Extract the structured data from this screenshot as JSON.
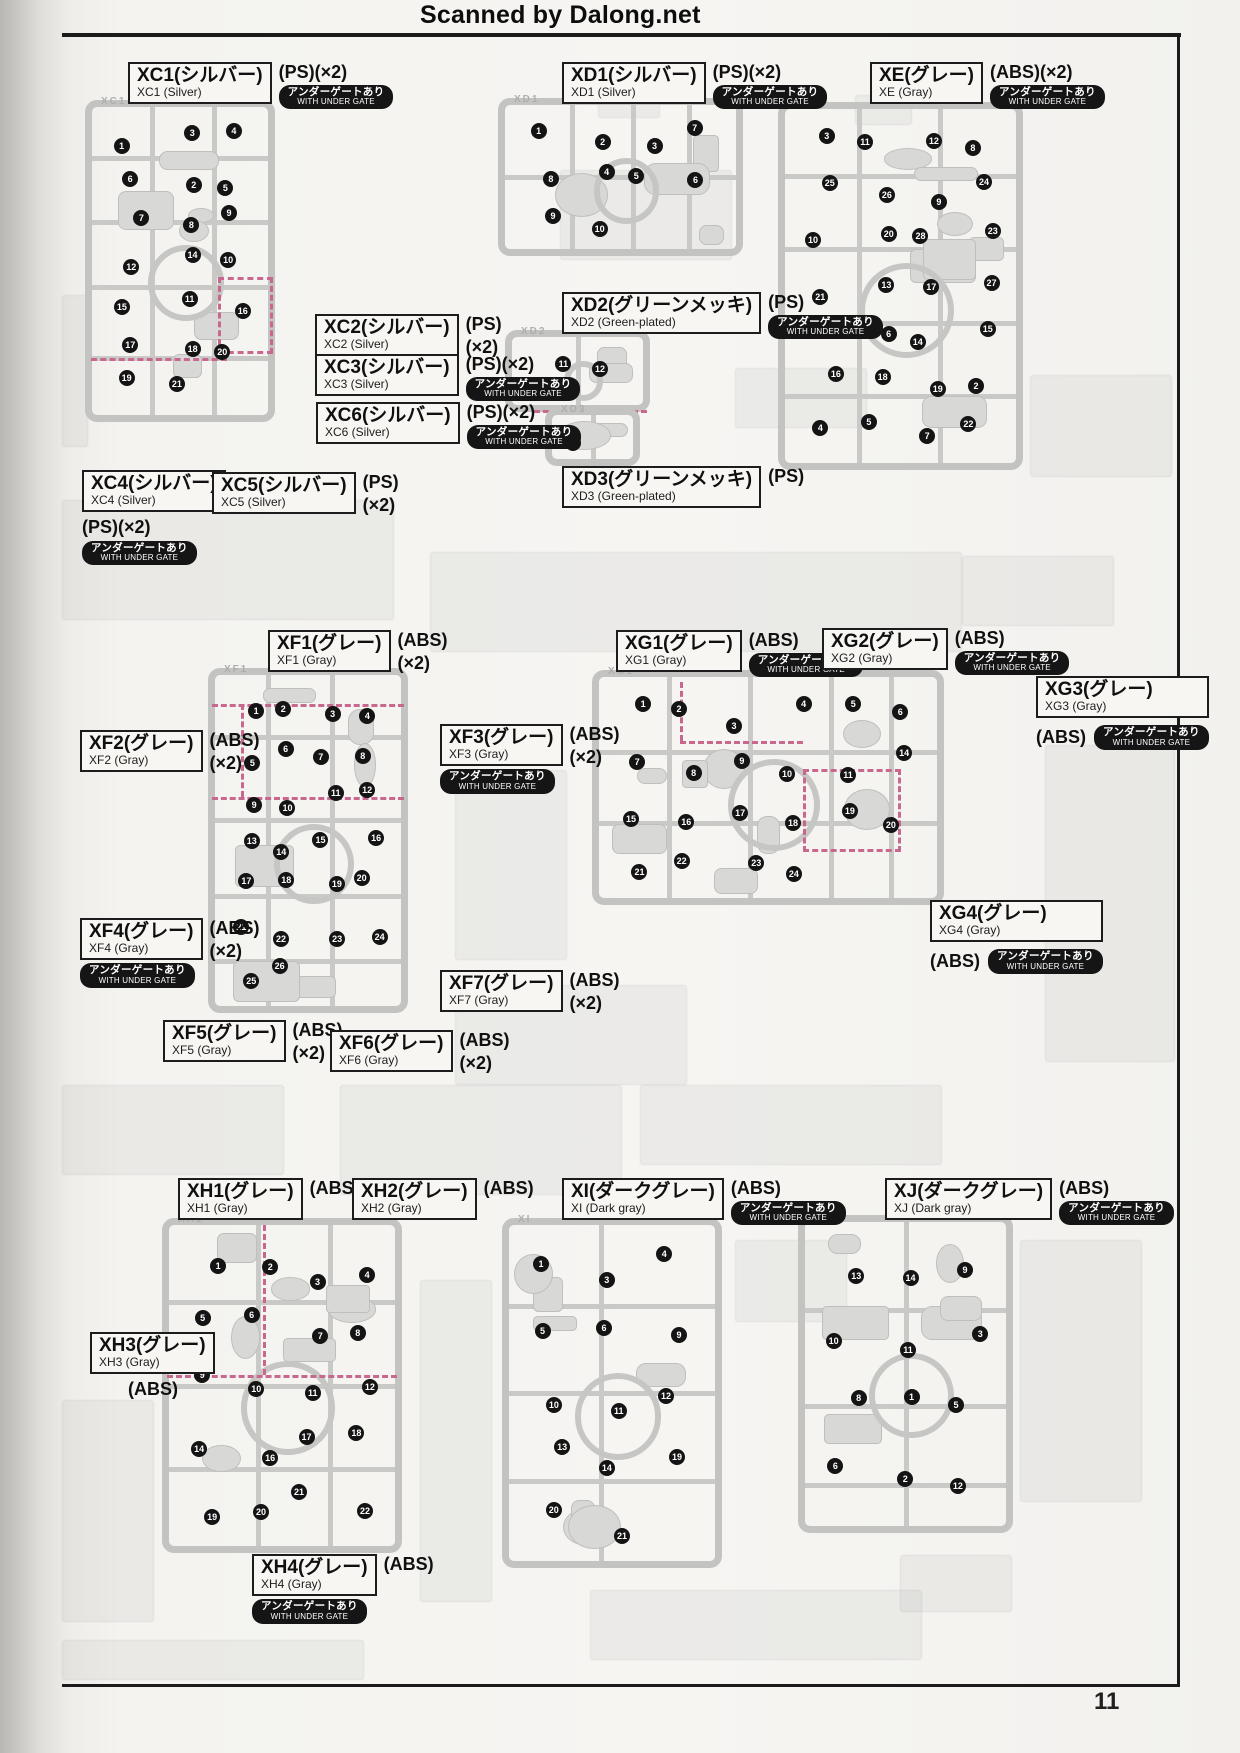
{
  "header": {
    "title": "Scanned by Dalong.net"
  },
  "footer": {
    "page_number": "11"
  },
  "badge": {
    "jp": "アンダーゲートあり",
    "en": "WITH UNDER GATE"
  },
  "labels": [
    {
      "id": "XC1",
      "jp": "XC1(シルバー)",
      "en": "XC1 (Silver)",
      "mat": "(PS)",
      "qty": "(×2)",
      "x": 128,
      "y": 62,
      "matPos": "right-inline",
      "badgePos": "under-mat"
    },
    {
      "id": "XD1",
      "jp": "XD1(シルバー)",
      "en": "XD1 (Silver)",
      "mat": "(PS)",
      "qty": "(×2)",
      "x": 562,
      "y": 62,
      "matPos": "right-inline",
      "badgePos": "under-mat"
    },
    {
      "id": "XE",
      "jp": "XE(グレー)",
      "en": "XE (Gray)",
      "mat": "(ABS)",
      "qty": "(×2)",
      "x": 870,
      "y": 62,
      "matPos": "right-inline",
      "badgePos": "under-mat"
    },
    {
      "id": "XC2",
      "jp": "XC2(シルバー)",
      "en": "XC2 (Silver)",
      "mat": "(PS)",
      "qty": "(×2)",
      "x": 315,
      "y": 314,
      "matPos": "right-stack",
      "badgePos": null
    },
    {
      "id": "XC3",
      "jp": "XC3(シルバー)",
      "en": "XC3 (Silver)",
      "mat": "(PS)",
      "qty": "(×2)",
      "x": 315,
      "y": 354,
      "matPos": "right-inline",
      "badgePos": "under-mat"
    },
    {
      "id": "XC6",
      "jp": "XC6(シルバー)",
      "en": "XC6 (Silver)",
      "mat": "(PS)",
      "qty": "(×2)",
      "x": 316,
      "y": 402,
      "matPos": "right-inline",
      "badgePos": "under-mat"
    },
    {
      "id": "XD2",
      "jp": "XD2(グリーンメッキ)",
      "en": "XD2 (Green-plated)",
      "mat": "(PS)",
      "qty": "",
      "x": 562,
      "y": 292,
      "matPos": "right-inline",
      "badgePos": "under-mat"
    },
    {
      "id": "XD3",
      "jp": "XD3(グリーンメッキ)",
      "en": "XD3 (Green-plated)",
      "mat": "(PS)",
      "qty": "",
      "x": 562,
      "y": 466,
      "matPos": "right-inline",
      "badgePos": null
    },
    {
      "id": "XC4",
      "jp": "XC4(シルバー)",
      "en": "XC4 (Silver)",
      "mat": "(PS)",
      "qty": "(×2)",
      "x": 82,
      "y": 470,
      "matPos": "below",
      "badgePos": "below"
    },
    {
      "id": "XC5",
      "jp": "XC5(シルバー)",
      "en": "XC5 (Silver)",
      "mat": "(PS)",
      "qty": "(×2)",
      "x": 212,
      "y": 472,
      "matPos": "right-stack",
      "badgePos": null
    },
    {
      "id": "XF1",
      "jp": "XF1(グレー)",
      "en": "XF1 (Gray)",
      "mat": "(ABS)",
      "qty": "(×2)",
      "x": 268,
      "y": 630,
      "matPos": "right-stack",
      "badgePos": null
    },
    {
      "id": "XG1",
      "jp": "XG1(グレー)",
      "en": "XG1 (Gray)",
      "mat": "(ABS)",
      "qty": "",
      "x": 616,
      "y": 630,
      "matPos": "right-inline",
      "badgePos": "under-mat"
    },
    {
      "id": "XG2",
      "jp": "XG2(グレー)",
      "en": "XG2 (Gray)",
      "mat": "(ABS)",
      "qty": "",
      "x": 822,
      "y": 628,
      "matPos": "right-inline",
      "badgePos": "under-mat"
    },
    {
      "id": "XG3",
      "jp": "XG3(グレー)",
      "en": "XG3 (Gray)",
      "mat": "(ABS)",
      "qty": "",
      "x": 1036,
      "y": 676,
      "matPos": "row-below",
      "badgePos": "row"
    },
    {
      "id": "XF2",
      "jp": "XF2(グレー)",
      "en": "XF2 (Gray)",
      "mat": "(ABS)",
      "qty": "(×2)",
      "x": 80,
      "y": 730,
      "matPos": "right-stack",
      "badgePos": null
    },
    {
      "id": "XF3",
      "jp": "XF3(グレー)",
      "en": "XF3 (Gray)",
      "mat": "(ABS)",
      "qty": "(×2)",
      "x": 440,
      "y": 724,
      "matPos": "right-stack",
      "badgePos": "below-box"
    },
    {
      "id": "XF4",
      "jp": "XF4(グレー)",
      "en": "XF4 (Gray)",
      "mat": "(ABS)",
      "qty": "(×2)",
      "x": 80,
      "y": 918,
      "matPos": "right-stack",
      "badgePos": "below-box"
    },
    {
      "id": "XG4",
      "jp": "XG4(グレー)",
      "en": "XG4 (Gray)",
      "mat": "(ABS)",
      "qty": "",
      "x": 930,
      "y": 900,
      "matPos": "row-below",
      "badgePos": "row"
    },
    {
      "id": "XF7",
      "jp": "XF7(グレー)",
      "en": "XF7 (Gray)",
      "mat": "(ABS)",
      "qty": "(×2)",
      "x": 440,
      "y": 970,
      "matPos": "right-stack",
      "badgePos": null
    },
    {
      "id": "XF5",
      "jp": "XF5(グレー)",
      "en": "XF5 (Gray)",
      "mat": "(ABS)",
      "qty": "(×2)",
      "x": 163,
      "y": 1020,
      "matPos": "right-stack",
      "badgePos": null
    },
    {
      "id": "XF6",
      "jp": "XF6(グレー)",
      "en": "XF6 (Gray)",
      "mat": "(ABS)",
      "qty": "(×2)",
      "x": 330,
      "y": 1030,
      "matPos": "right-stack",
      "badgePos": null
    },
    {
      "id": "XH1",
      "jp": "XH1(グレー)",
      "en": "XH1 (Gray)",
      "mat": "(ABS)",
      "qty": "",
      "x": 178,
      "y": 1178,
      "matPos": "right-inline",
      "badgePos": null
    },
    {
      "id": "XH2",
      "jp": "XH2(グレー)",
      "en": "XH2 (Gray)",
      "mat": "(ABS)",
      "qty": "",
      "x": 352,
      "y": 1178,
      "matPos": "right-inline",
      "badgePos": null
    },
    {
      "id": "XI",
      "jp": "XI(ダークグレー)",
      "en": "XI (Dark gray)",
      "mat": "(ABS)",
      "qty": "",
      "x": 562,
      "y": 1178,
      "matPos": "right-inline",
      "badgePos": "under-mat"
    },
    {
      "id": "XJ",
      "jp": "XJ(ダークグレー)",
      "en": "XJ (Dark gray)",
      "mat": "(ABS)",
      "qty": "",
      "x": 885,
      "y": 1178,
      "matPos": "right-inline",
      "badgePos": "under-mat"
    },
    {
      "id": "XH3",
      "jp": "XH3(グレー)",
      "en": "XH3 (Gray)",
      "mat": "(ABS)",
      "qty": "",
      "x": 90,
      "y": 1332,
      "matPos": "below-indent",
      "badgePos": null
    },
    {
      "id": "XH4",
      "jp": "XH4(グレー)",
      "en": "XH4 (Gray)",
      "mat": "(ABS)",
      "qty": "",
      "x": 252,
      "y": 1554,
      "matPos": "right-inline",
      "badgePos": "below-box"
    }
  ],
  "runners": [
    {
      "id": "XC1",
      "x": 85,
      "y": 100,
      "w": 190,
      "h": 322,
      "ring": true,
      "vbars": [
        0.35,
        0.68
      ],
      "hbars": [
        0.18,
        0.38,
        0.58,
        0.8
      ],
      "dashes": [
        {
          "t": "h",
          "f": 0.8,
          "a": 0.03,
          "b": 0.75
        },
        {
          "t": "rect",
          "x": 0.7,
          "y": 0.55,
          "w": 0.26,
          "h": 0.22
        }
      ],
      "markers": [
        "1",
        "3",
        "4",
        "6",
        "2",
        "5",
        "7",
        "8",
        "9",
        "12",
        "14",
        "10",
        "15",
        "11",
        "16",
        "17",
        "18",
        "20",
        "19",
        "21"
      ]
    },
    {
      "id": "XD1",
      "x": 498,
      "y": 98,
      "w": 245,
      "h": 158,
      "ring": true,
      "vbars": [
        0.3,
        0.55,
        0.78
      ],
      "hbars": [
        0.5
      ],
      "dashes": [],
      "markers": [
        "1",
        "2",
        "3",
        "7",
        "8",
        "4",
        "5",
        "6",
        "9",
        "10"
      ]
    },
    {
      "id": "XD2",
      "x": 505,
      "y": 330,
      "w": 145,
      "h": 82,
      "ring": true,
      "vbars": [
        0.5
      ],
      "hbars": [],
      "dashes": [
        {
          "t": "h",
          "f": 0.97,
          "a": 0.2,
          "b": 0.98
        }
      ],
      "markers": [
        "11",
        "12"
      ]
    },
    {
      "id": "XD3",
      "x": 545,
      "y": 408,
      "w": 95,
      "h": 58,
      "ring": false,
      "vbars": [
        0.5
      ],
      "hbars": [],
      "dashes": [],
      "markers": [
        "13"
      ]
    },
    {
      "id": "XE",
      "x": 778,
      "y": 102,
      "w": 245,
      "h": 368,
      "ring": true,
      "vbars": [
        0.33,
        0.66
      ],
      "hbars": [
        0.2,
        0.4,
        0.6,
        0.8
      ],
      "dashes": [],
      "markers": [
        "3",
        "11",
        "12",
        "8",
        "25",
        "26",
        "9",
        "24",
        "10",
        "20",
        "28",
        "23",
        "21",
        "13",
        "17",
        "27",
        "1",
        "6",
        "14",
        "15",
        "16",
        "18",
        "19",
        "2",
        "4",
        "5",
        "7",
        "22"
      ]
    },
    {
      "id": "XF1",
      "x": 208,
      "y": 668,
      "w": 200,
      "h": 345,
      "ring": true,
      "vbars": [
        0.3,
        0.62
      ],
      "hbars": [
        0.2,
        0.44,
        0.66,
        0.85
      ],
      "dashes": [
        {
          "t": "h",
          "f": 0.105,
          "a": 0.02,
          "b": 0.98
        },
        {
          "t": "h",
          "f": 0.375,
          "a": 0.02,
          "b": 0.98
        },
        {
          "t": "v",
          "f": 0.165,
          "a": 0.105,
          "b": 0.375
        }
      ],
      "markers": [
        "1",
        "2",
        "3",
        "4",
        "5",
        "6",
        "7",
        "8",
        "9",
        "10",
        "11",
        "12",
        "13",
        "14",
        "15",
        "16",
        "17",
        "18",
        "19",
        "20",
        "21",
        "22",
        "23",
        "24",
        "25",
        "26"
      ]
    },
    {
      "id": "XG1",
      "x": 592,
      "y": 670,
      "w": 352,
      "h": 235,
      "ring": true,
      "vbars": [
        0.22,
        0.45,
        0.68,
        0.85
      ],
      "hbars": [
        0.35,
        0.65
      ],
      "dashes": [
        {
          "t": "h",
          "f": 0.3,
          "a": 0.25,
          "b": 0.6
        },
        {
          "t": "rect",
          "x": 0.6,
          "y": 0.42,
          "w": 0.26,
          "h": 0.33
        },
        {
          "t": "v",
          "f": 0.25,
          "a": 0.05,
          "b": 0.3
        }
      ],
      "markers": [
        "1",
        "2",
        "3",
        "4",
        "5",
        "6",
        "7",
        "8",
        "9",
        "10",
        "11",
        "14",
        "15",
        "16",
        "17",
        "18",
        "19",
        "20",
        "21",
        "22",
        "23",
        "24"
      ]
    },
    {
      "id": "XH1",
      "x": 162,
      "y": 1218,
      "w": 240,
      "h": 335,
      "ring": true,
      "vbars": [
        0.4,
        0.7
      ],
      "hbars": [
        0.25,
        0.5,
        0.75
      ],
      "dashes": [
        {
          "t": "v",
          "f": 0.42,
          "a": 0.02,
          "b": 0.47
        },
        {
          "t": "h",
          "f": 0.47,
          "a": 0.02,
          "b": 0.98
        }
      ],
      "markers": [
        "1",
        "2",
        "3",
        "4",
        "5",
        "6",
        "7",
        "8",
        "9",
        "10",
        "11",
        "12",
        "14",
        "16",
        "17",
        "18",
        "19",
        "20",
        "21",
        "22"
      ]
    },
    {
      "id": "XI",
      "x": 502,
      "y": 1218,
      "w": 220,
      "h": 350,
      "ring": true,
      "vbars": [
        0.45
      ],
      "hbars": [
        0.25,
        0.5,
        0.75
      ],
      "dashes": [],
      "markers": [
        "1",
        "3",
        "4",
        "5",
        "6",
        "9",
        "10",
        "11",
        "12",
        "13",
        "14",
        "19",
        "20",
        "21"
      ]
    },
    {
      "id": "XJ",
      "x": 798,
      "y": 1215,
      "w": 215,
      "h": 318,
      "ring": true,
      "vbars": [
        0.5
      ],
      "hbars": [
        0.3,
        0.6,
        0.85
      ],
      "dashes": [],
      "markers": [
        "13",
        "14",
        "9",
        "10",
        "11",
        "3",
        "8",
        "1",
        "5",
        "6",
        "2",
        "12"
      ]
    }
  ],
  "ghosts": [
    {
      "x": 598,
      "y": 66,
      "w": 60,
      "h": 50
    },
    {
      "x": 560,
      "y": 170,
      "w": 170,
      "h": 88
    },
    {
      "x": 855,
      "y": 95,
      "w": 55,
      "h": 28
    },
    {
      "x": 1030,
      "y": 375,
      "w": 140,
      "h": 100
    },
    {
      "x": 735,
      "y": 368,
      "w": 130,
      "h": 58
    },
    {
      "x": 62,
      "y": 295,
      "w": 24,
      "h": 150
    },
    {
      "x": 62,
      "y": 500,
      "w": 330,
      "h": 118
    },
    {
      "x": 430,
      "y": 552,
      "w": 530,
      "h": 98
    },
    {
      "x": 962,
      "y": 556,
      "w": 150,
      "h": 68
    },
    {
      "x": 1045,
      "y": 745,
      "w": 128,
      "h": 315
    },
    {
      "x": 455,
      "y": 770,
      "w": 110,
      "h": 188
    },
    {
      "x": 455,
      "y": 985,
      "w": 230,
      "h": 98
    },
    {
      "x": 62,
      "y": 1085,
      "w": 220,
      "h": 88
    },
    {
      "x": 340,
      "y": 1085,
      "w": 280,
      "h": 108
    },
    {
      "x": 640,
      "y": 1085,
      "w": 300,
      "h": 78
    },
    {
      "x": 735,
      "y": 1240,
      "w": 110,
      "h": 80
    },
    {
      "x": 1020,
      "y": 1240,
      "w": 120,
      "h": 260
    },
    {
      "x": 62,
      "y": 1400,
      "w": 90,
      "h": 220
    },
    {
      "x": 420,
      "y": 1280,
      "w": 70,
      "h": 320
    },
    {
      "x": 590,
      "y": 1590,
      "w": 330,
      "h": 68
    },
    {
      "x": 900,
      "y": 1555,
      "w": 110,
      "h": 55
    },
    {
      "x": 62,
      "y": 1640,
      "w": 300,
      "h": 38
    }
  ]
}
